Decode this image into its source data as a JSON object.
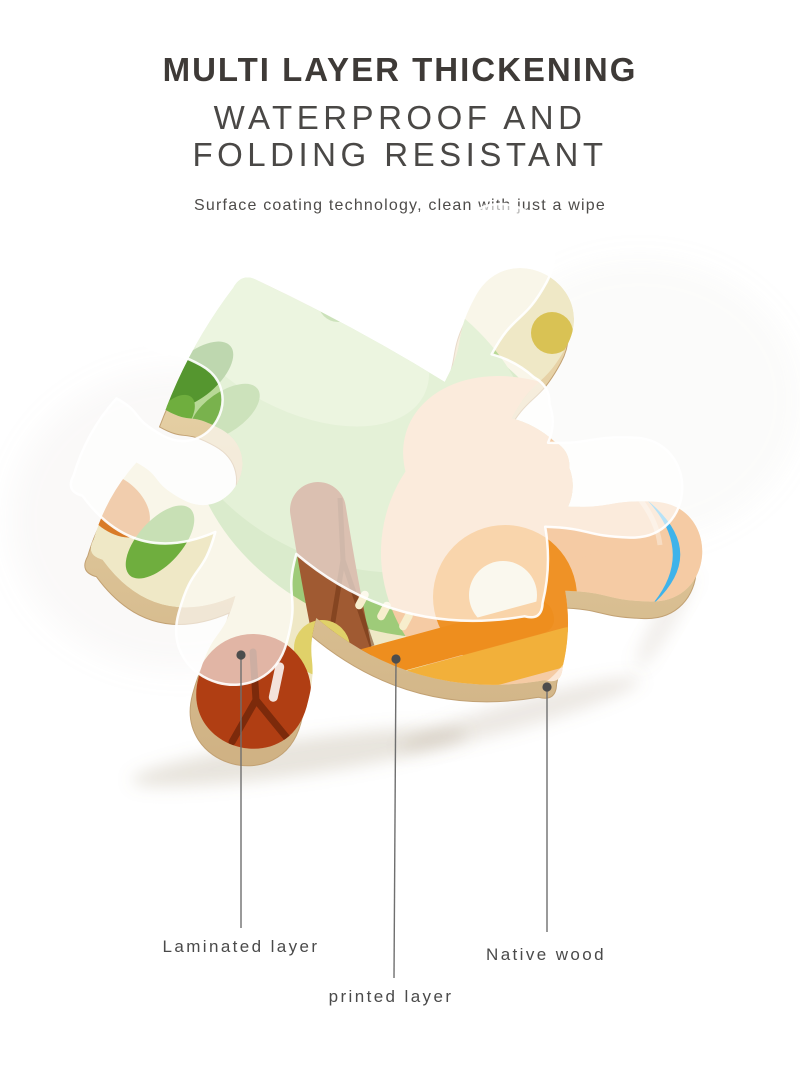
{
  "header": {
    "title": "MULTI LAYER THICKENING",
    "subtitle_line1": "WATERPROOF AND",
    "subtitle_line2": "FOLDING RESISTANT",
    "tagline": "Surface coating technology, clean with just a wipe"
  },
  "text_colors": {
    "title": "#3e3a37",
    "subtitle": "#4a4846",
    "tagline": "#4e4c4a",
    "label": "#4a4a4a"
  },
  "diagram": {
    "line_color": "#6f6f6f",
    "dot_color": "#4d4d4d",
    "annotations": [
      {
        "id": "laminated",
        "label": "Laminated layer",
        "dot": {
          "x": 241,
          "y": 655
        },
        "end": {
          "x": 241,
          "y": 928
        },
        "label_pos": {
          "x": 241,
          "y": 947
        }
      },
      {
        "id": "printed",
        "label": "printed layer",
        "dot": {
          "x": 396,
          "y": 659
        },
        "end": {
          "x": 394,
          "y": 978
        },
        "label_pos": {
          "x": 391,
          "y": 997
        }
      },
      {
        "id": "wood",
        "label": "Native wood",
        "dot": {
          "x": 547,
          "y": 687
        },
        "end": {
          "x": 547,
          "y": 932
        },
        "label_pos": {
          "x": 546,
          "y": 955
        }
      }
    ],
    "piece_colors": {
      "base_cream": "#efe8c6",
      "green_light": "#b8d996",
      "green_mid": "#9ecb79",
      "green_tint": "#cde4af",
      "green_dark": "#6fae3e",
      "leaf_dark": "#55962f",
      "leaf_mid": "#79b24d",
      "pink": "#eb7f83",
      "peach": "#f5cba4",
      "orange": "#ef9226",
      "orange_deep": "#ee8e1e",
      "gold": "#f2b03a",
      "brown_trunk": "#a05a32",
      "brown_dark": "#6f3414",
      "red_knob": "#b03e13",
      "red_dark": "#7c2a0b",
      "blue": "#3fb3ea",
      "yellow": "#d9c254",
      "yellow_soft": "#e0d169",
      "left_orange": "#d97b28",
      "wood_light": "#ecd9ae",
      "wood_dark": "#cfb183",
      "wood_stroke": "#c2a173",
      "overlay_fill": "rgba(255,255,255,0.62)",
      "overlay_rim": "rgba(255,255,255,0.92)"
    }
  }
}
